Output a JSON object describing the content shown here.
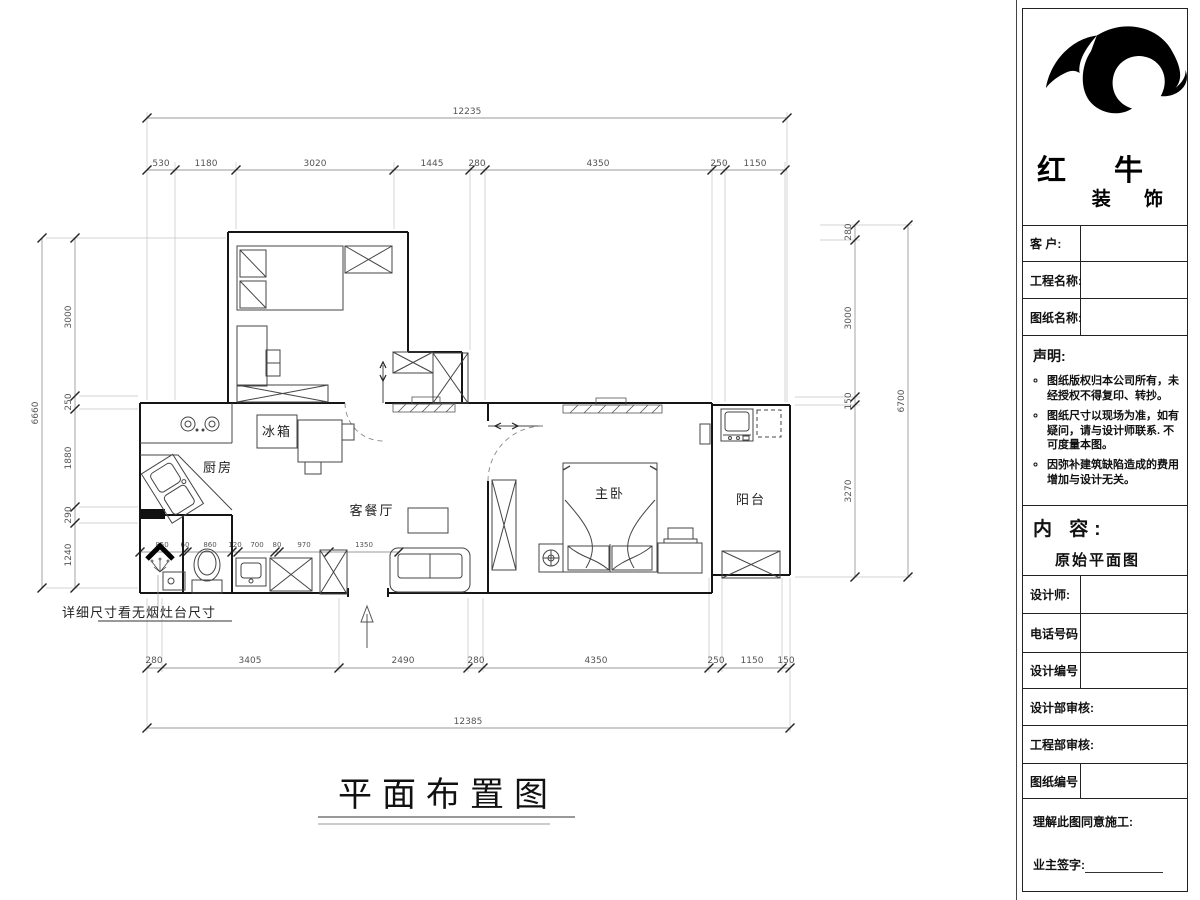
{
  "plan": {
    "title": "平面布置图",
    "note": "详细尺寸看无烟灶台尺寸",
    "rooms": {
      "kitchen": "厨房",
      "fridge": "冰箱",
      "living": "客餐厅",
      "bedroom": "主卧",
      "balcony": "阳台"
    },
    "dims": {
      "top_total": "12235",
      "top": [
        "530",
        "1180",
        "3020",
        "1445",
        "280",
        "4350",
        "250",
        "1150"
      ],
      "bottom_total": "12385",
      "bottom": [
        "280",
        "3405",
        "2490",
        "280",
        "4350",
        "250",
        "1150",
        "150"
      ],
      "left_total": "6660",
      "left": [
        "3000",
        "250",
        "1880",
        "290",
        "1240"
      ],
      "right_total": "6700",
      "right": [
        "280",
        "3000",
        "150",
        "3270"
      ],
      "kitchen_row": [
        "850",
        "60",
        "860",
        "120",
        "700",
        "80",
        "970",
        "1350"
      ]
    }
  },
  "titleblock": {
    "brand_line1": "红 牛",
    "brand_line2": "装 饰",
    "customer_label": "客  户:",
    "project_label": "工程名称:",
    "drawing_label": "图纸名称:",
    "statement_title": "声明:",
    "statement_items": [
      "图纸版权归本公司所有，未经授权不得复印、转抄。",
      "图纸尺寸以现场为准，如有疑问，请与设计师联系. 不可度量本图。",
      "因弥补建筑缺陷造成的费用增加与设计无关。"
    ],
    "content_label": "内 容:",
    "content_value": "原始平面图",
    "designer_label": "设计师:",
    "phone_label": "电话号码",
    "design_no_label": "设计编号",
    "design_review_label": "设计部审核:",
    "eng_review_label": "工程部审核:",
    "drawing_no_label": "图纸编号",
    "agree_label": "理解此图同意施工:",
    "owner_sign_label": "业主签字:"
  }
}
